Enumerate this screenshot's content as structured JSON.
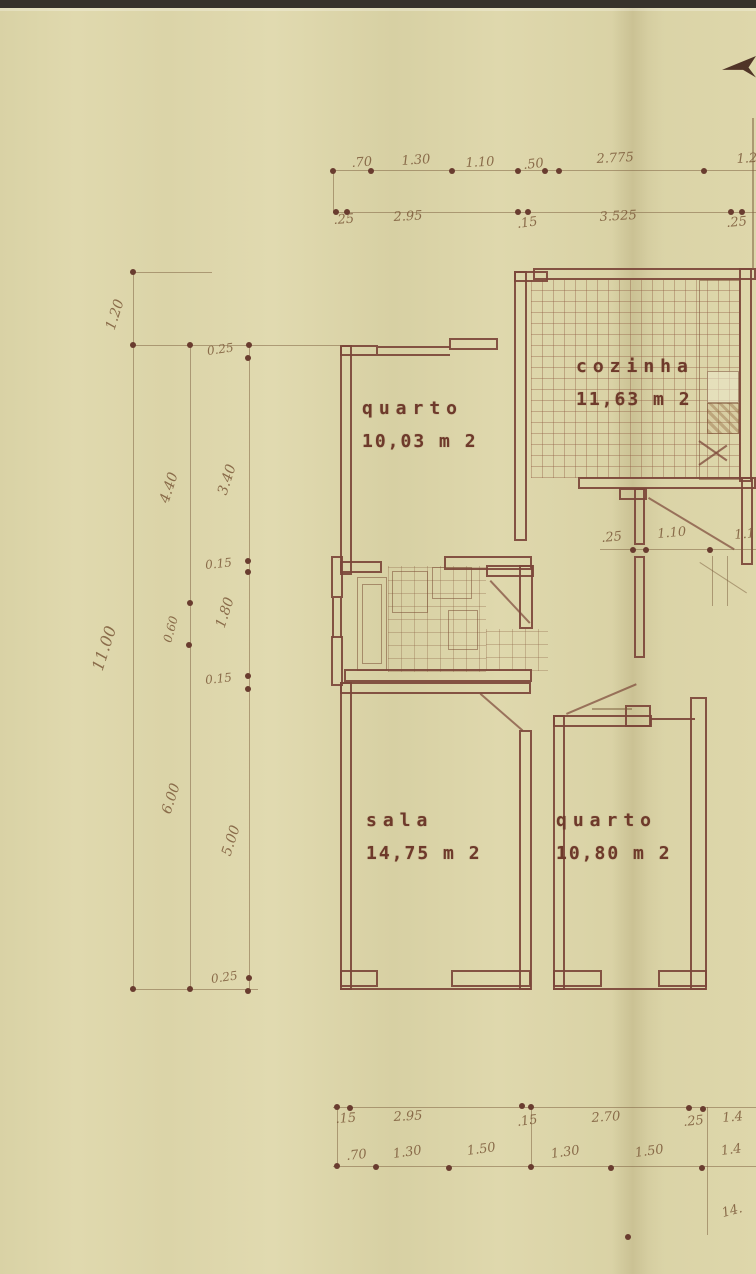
{
  "palette": {
    "paper": "#dcd5aa",
    "wall_ink": "#7c4739",
    "room_text": "#6e3a2b",
    "pencil_text": "#7c5a3a",
    "scan_band": "#37322b"
  },
  "plan": {
    "rooms": [
      {
        "key": "quarto-1",
        "name": "quarto",
        "area": "10,03 m 2",
        "x": 362,
        "y": 398
      },
      {
        "key": "cozinha",
        "name": "cozinha",
        "area": "11,63 m 2",
        "x": 576,
        "y": 356
      },
      {
        "key": "sala",
        "name": "sala",
        "area": "14,75 m 2",
        "x": 366,
        "y": 810
      },
      {
        "key": "quarto-2",
        "name": "quarto",
        "area": "10,80 m 2",
        "x": 556,
        "y": 810
      }
    ],
    "dim_labels": [
      {
        "t": ".70",
        "x": 352,
        "y": 156,
        "r": -4
      },
      {
        "t": "1.30",
        "x": 402,
        "y": 154,
        "r": -4
      },
      {
        "t": "1.10",
        "x": 466,
        "y": 156,
        "r": -3
      },
      {
        "t": ".50",
        "x": 524,
        "y": 158,
        "r": -6
      },
      {
        "t": "2.775",
        "x": 597,
        "y": 152,
        "r": -3
      },
      {
        "t": "1.2",
        "x": 737,
        "y": 152,
        "r": -3
      },
      {
        "t": ".25",
        "x": 334,
        "y": 213,
        "r": -4
      },
      {
        "t": "2.95",
        "x": 394,
        "y": 210,
        "r": -3
      },
      {
        "t": ".15",
        "x": 518,
        "y": 217,
        "r": -8
      },
      {
        "t": "3.525",
        "x": 600,
        "y": 210,
        "r": -3
      },
      {
        "t": ".25",
        "x": 727,
        "y": 216,
        "r": -5
      },
      {
        "t": "1.20",
        "x": 118,
        "y": 316,
        "r": -72,
        "s": 14
      },
      {
        "t": "0.25",
        "x": 208,
        "y": 344,
        "r": -8,
        "s": 12
      },
      {
        "t": "4.40",
        "x": 172,
        "y": 489,
        "r": -72,
        "s": 14
      },
      {
        "t": "3.40",
        "x": 230,
        "y": 481,
        "r": -72,
        "s": 14
      },
      {
        "t": "11.00",
        "x": 106,
        "y": 654,
        "r": -72,
        "s": 16
      },
      {
        "t": "0.15",
        "x": 206,
        "y": 558,
        "r": -6,
        "s": 12
      },
      {
        "t": "0.60",
        "x": 174,
        "y": 630,
        "r": -75,
        "s": 12
      },
      {
        "t": "1.80",
        "x": 228,
        "y": 614,
        "r": -72,
        "s": 14
      },
      {
        "t": "0.15",
        "x": 206,
        "y": 673,
        "r": -6,
        "s": 12
      },
      {
        "t": "6.00",
        "x": 174,
        "y": 800,
        "r": -72,
        "s": 14
      },
      {
        "t": "5.00",
        "x": 234,
        "y": 842,
        "r": -72,
        "s": 14
      },
      {
        "t": "0.25",
        "x": 212,
        "y": 972,
        "r": -8,
        "s": 12
      },
      {
        "t": ".25",
        "x": 602,
        "y": 531,
        "r": -5
      },
      {
        "t": "1.10",
        "x": 658,
        "y": 527,
        "r": -5
      },
      {
        "t": "1.1",
        "x": 735,
        "y": 528,
        "r": -5
      },
      {
        "t": ".15",
        "x": 336,
        "y": 1112,
        "r": -4
      },
      {
        "t": "2.95",
        "x": 394,
        "y": 1110,
        "r": -3
      },
      {
        "t": ".15",
        "x": 518,
        "y": 1115,
        "r": -8
      },
      {
        "t": "2.70",
        "x": 592,
        "y": 1111,
        "r": -4
      },
      {
        "t": ".25",
        "x": 684,
        "y": 1115,
        "r": -6
      },
      {
        "t": "1.4",
        "x": 723,
        "y": 1111,
        "r": -5
      },
      {
        "t": ".70",
        "x": 347,
        "y": 1149,
        "r": -6
      },
      {
        "t": "1.30",
        "x": 394,
        "y": 1147,
        "r": -8
      },
      {
        "t": "1.50",
        "x": 468,
        "y": 1144,
        "r": -8
      },
      {
        "t": "1.30",
        "x": 552,
        "y": 1147,
        "r": -8
      },
      {
        "t": "1.50",
        "x": 636,
        "y": 1146,
        "r": -8
      },
      {
        "t": "1.4",
        "x": 722,
        "y": 1144,
        "r": -8
      },
      {
        "t": "14.",
        "x": 724,
        "y": 1206,
        "r": -15,
        "s": 13
      }
    ],
    "dots": [
      [
        333,
        171
      ],
      [
        371,
        171
      ],
      [
        452,
        171
      ],
      [
        518,
        171
      ],
      [
        545,
        171
      ],
      [
        559,
        171
      ],
      [
        704,
        171
      ],
      [
        336,
        212
      ],
      [
        347,
        212
      ],
      [
        518,
        212
      ],
      [
        528,
        212
      ],
      [
        731,
        212
      ],
      [
        742,
        212
      ],
      [
        133,
        272
      ],
      [
        133,
        345
      ],
      [
        190,
        345
      ],
      [
        249,
        345
      ],
      [
        248,
        358
      ],
      [
        248,
        561
      ],
      [
        248,
        572
      ],
      [
        190,
        603
      ],
      [
        189,
        645
      ],
      [
        248,
        676
      ],
      [
        248,
        689
      ],
      [
        133,
        989
      ],
      [
        190,
        989
      ],
      [
        249,
        978
      ],
      [
        248,
        991
      ],
      [
        633,
        550
      ],
      [
        646,
        550
      ],
      [
        710,
        550
      ],
      [
        337,
        1107
      ],
      [
        350,
        1108
      ],
      [
        522,
        1106
      ],
      [
        531,
        1107
      ],
      [
        689,
        1108
      ],
      [
        703,
        1109
      ],
      [
        337,
        1166
      ],
      [
        376,
        1167
      ],
      [
        449,
        1168
      ],
      [
        531,
        1167
      ],
      [
        611,
        1168
      ],
      [
        702,
        1168
      ],
      [
        628,
        1237
      ]
    ]
  }
}
